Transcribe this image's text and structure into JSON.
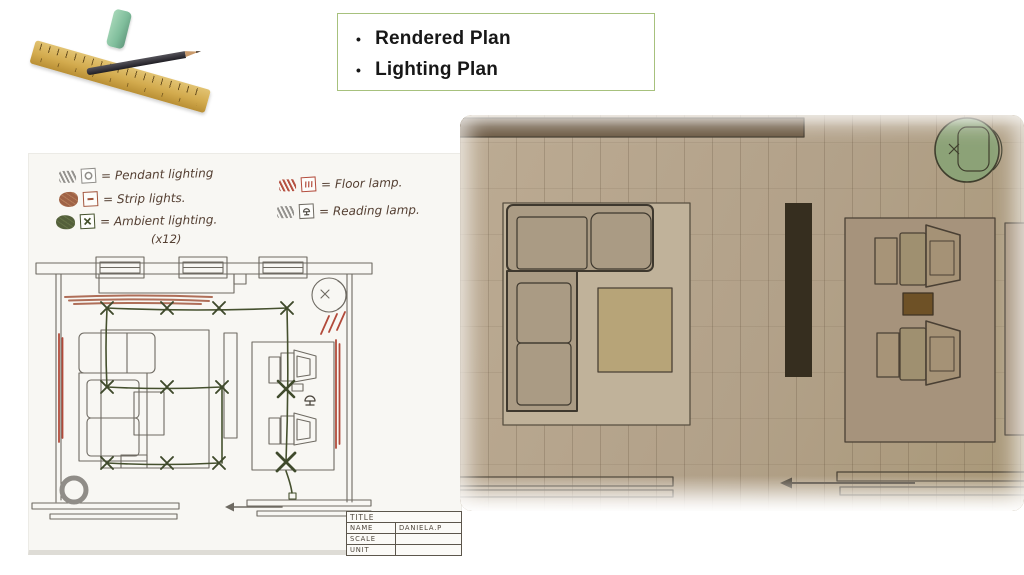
{
  "slide": {
    "bullet_char": "•",
    "bullets": [
      "Rendered Plan",
      "Lighting Plan"
    ]
  },
  "lighting_plan": {
    "legend": {
      "pendant": {
        "label": "= Pendant lighting"
      },
      "strip": {
        "label": "= Strip lights."
      },
      "ambient": {
        "label": "= Ambient lighting.",
        "count_note": "(x12)"
      },
      "floor": {
        "label": "= Floor lamp."
      },
      "reading": {
        "label": "= Reading lamp."
      }
    },
    "title_block": {
      "title": "TITLE",
      "rows": [
        {
          "label": "NAME",
          "value": "DANIELA.P"
        },
        {
          "label": "SCALE",
          "value": ""
        },
        {
          "label": "UNIT",
          "value": ""
        }
      ]
    }
  },
  "icons": {
    "pendant_symbol": "circle-in-box",
    "strip_symbol": "dash-in-box",
    "ambient_symbol": "x-in-box",
    "floor_symbol": "hatch-in-box",
    "reading_symbol": "lamp-in-box",
    "entry_arrow": "left-arrow",
    "clipart": [
      "ruler",
      "pencil",
      "eraser"
    ]
  },
  "colors": {
    "agenda_border": "#a7c17d",
    "pencil_ink": "#6e6a62",
    "ambient_green": "#45502e",
    "strip_brown": "#a86048",
    "floor_lamp_red": "#b24a3a",
    "pendant_gray": "#8f8d89",
    "handwriting_ink": "#543f32",
    "photo_floor": "#b2a189",
    "photo_wall": "#67543d",
    "photo_rug": "#a6937c",
    "photo_chair_green": "#8ca277"
  }
}
